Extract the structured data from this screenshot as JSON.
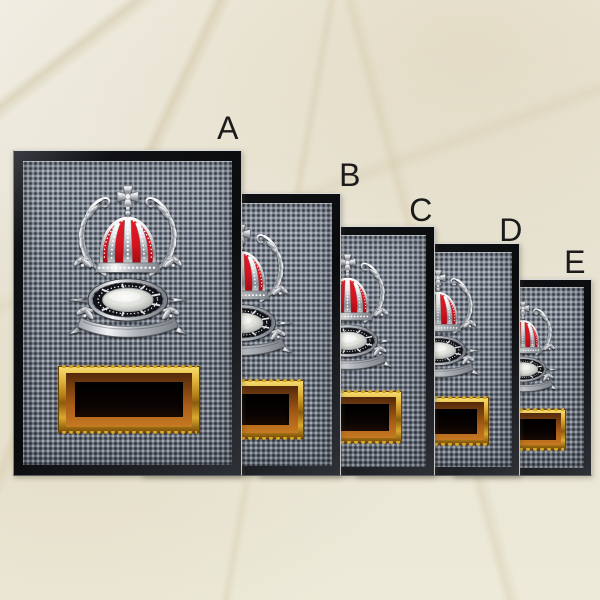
{
  "image": {
    "width": 600,
    "height": 600,
    "kind": "product size comparison photo"
  },
  "background": {
    "material": "marble",
    "base_color": "#ebe7da",
    "vein_color": "#cdbf9c"
  },
  "plaques": [
    {
      "label": "A",
      "z": 50,
      "box": {
        "left": 13,
        "top": 150,
        "width": 227,
        "height": 324
      },
      "label_pos": {
        "x": 228,
        "y": 128
      }
    },
    {
      "label": "B",
      "z": 40,
      "box": {
        "left": 142,
        "top": 193,
        "width": 197,
        "height": 281
      },
      "label_pos": {
        "x": 350,
        "y": 175
      }
    },
    {
      "label": "C",
      "z": 30,
      "box": {
        "left": 259,
        "top": 226,
        "width": 174,
        "height": 248
      },
      "label_pos": {
        "x": 421,
        "y": 210
      }
    },
    {
      "label": "D",
      "z": 20,
      "box": {
        "left": 356,
        "top": 243,
        "width": 162,
        "height": 231
      },
      "label_pos": {
        "x": 511,
        "y": 230
      }
    },
    {
      "label": "E",
      "z": 10,
      "box": {
        "left": 453,
        "top": 279,
        "width": 137,
        "height": 195
      },
      "label_pos": {
        "x": 575,
        "y": 262
      }
    }
  ],
  "plaque_style": {
    "surface_color": "#747d8b",
    "frame_color": "#0d0e11",
    "frame_highlight": "#d9dbdc",
    "crown_red": "#d2141f",
    "silver": "#dfe2e6",
    "plate_gold": "#d9a92c",
    "plate_copper": "#a85c16",
    "plate_black": "#060302"
  },
  "emblem": {
    "icon": "crown-laurel-medallion-emblem",
    "elements": [
      "maltese-cross",
      "jeweled-crown",
      "laurel-branches",
      "oval-medallion",
      "ribbon-banner"
    ]
  }
}
